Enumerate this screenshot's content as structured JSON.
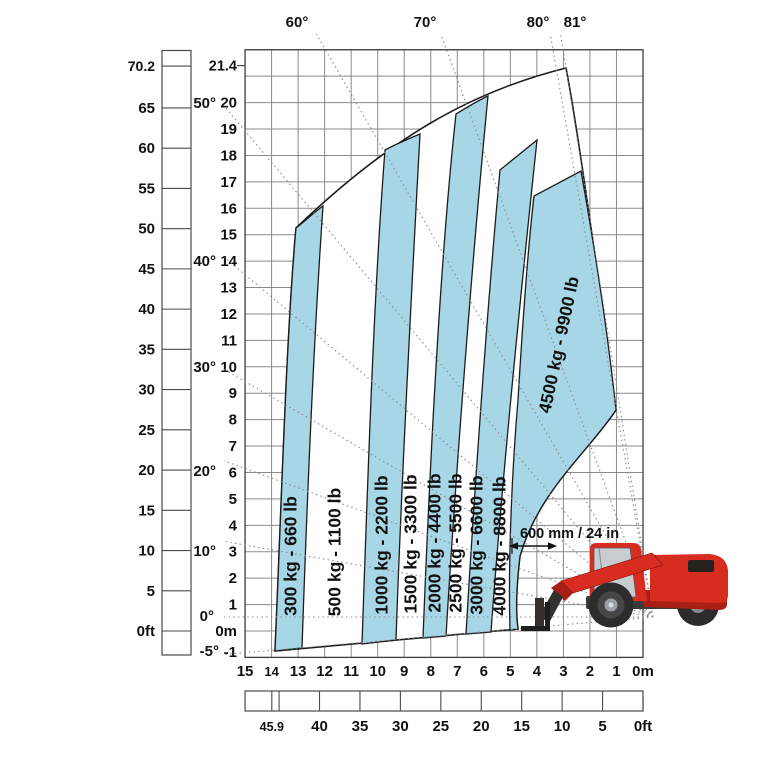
{
  "chart_data": {
    "type": "area",
    "title": "Telescopic handler load capacity chart",
    "height_axis_ft": {
      "unit": "ft",
      "ticks": [
        "70.2",
        "65",
        "60",
        "55",
        "50",
        "45",
        "40",
        "35",
        "30",
        "25",
        "20",
        "15",
        "10",
        "5",
        "0ft"
      ]
    },
    "height_axis_m": {
      "unit": "m",
      "ticks": [
        "21.4",
        "20",
        "19",
        "18",
        "17",
        "16",
        "15",
        "14",
        "13",
        "12",
        "11",
        "10",
        "9",
        "8",
        "7",
        "6",
        "5",
        "4",
        "3",
        "2",
        "1",
        "0m",
        "-1"
      ]
    },
    "reach_axis_m": {
      "unit": "m",
      "ticks": [
        "15",
        "14",
        "13",
        "12",
        "11",
        "10",
        "9",
        "8",
        "7",
        "6",
        "5",
        "4",
        "3",
        "2",
        "1",
        "0m"
      ]
    },
    "reach_axis_ft": {
      "unit": "ft",
      "ticks": [
        "45.9",
        "40",
        "35",
        "30",
        "25",
        "20",
        "15",
        "10",
        "5",
        "0ft"
      ]
    },
    "boom_angles": {
      "left": [
        "-5°",
        "0°",
        "10°",
        "20°",
        "30°",
        "40°",
        "50°"
      ],
      "top": [
        "60°",
        "70°",
        "80°",
        "81°"
      ]
    },
    "capacity_zones": [
      {
        "label": "300 kg - 660 lb",
        "filled": true
      },
      {
        "label": "500 kg - 1100 lb",
        "filled": false
      },
      {
        "label": "1000 kg - 2200 lb",
        "filled": true
      },
      {
        "label": "1500 kg - 3300 lb",
        "filled": false
      },
      {
        "label": "2000 kg - 4400 lb",
        "filled": true
      },
      {
        "label": "2500 kg - 5500 lb",
        "filled": false
      },
      {
        "label": "3000 kg - 6600 lb",
        "filled": true
      },
      {
        "label": "4000 kg - 8800 lb",
        "filled": false
      },
      {
        "label": "4500 kg - 9900 lb",
        "filled": true
      }
    ],
    "load_center_note": "600 mm / 24 in",
    "grid": true,
    "axis_ranges": {
      "reach_m": [
        0,
        15
      ],
      "height_m": [
        -1,
        22
      ]
    },
    "colors": {
      "zone_fill": "#a7d7e6",
      "outline": "#1c1c1c",
      "grid": "#8a8a8a",
      "machine_red": "#d92c20",
      "machine_dark_red": "#a81f16",
      "machine_dark": "#33302e",
      "glass": "#c7ccd1"
    }
  }
}
